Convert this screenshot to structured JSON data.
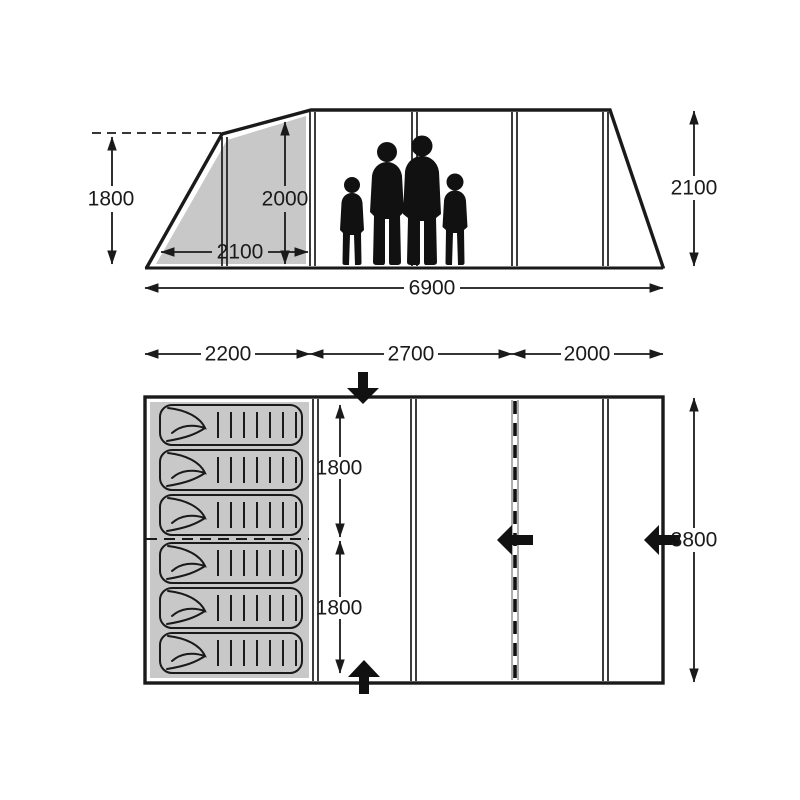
{
  "side_view": {
    "porch_peak_height": "1800",
    "porch_inner_height": "2000",
    "porch_depth": "2100",
    "total_length": "6900",
    "main_height": "2100"
  },
  "floor_plan": {
    "bedroom_length": "2200",
    "living_length": "2700",
    "front_length": "2000",
    "sleep_zone_top": "1800",
    "sleep_zone_bottom": "1800",
    "total_width": "3800"
  },
  "colors": {
    "shaded_fill": "#c8c8c8",
    "line": "#1a1a1a"
  }
}
